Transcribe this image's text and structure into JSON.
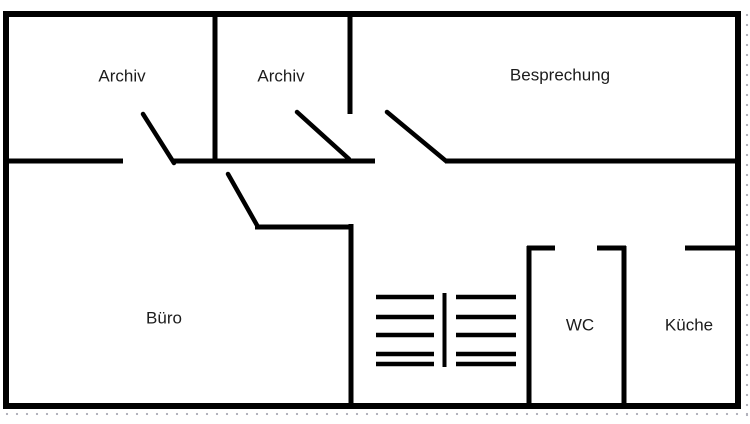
{
  "floorplan": {
    "rooms": [
      {
        "id": "archiv-1",
        "label": "Archiv"
      },
      {
        "id": "archiv-2",
        "label": "Archiv"
      },
      {
        "id": "besprechung",
        "label": "Besprechung"
      },
      {
        "id": "buero",
        "label": "Büro"
      },
      {
        "id": "wc",
        "label": "WC"
      },
      {
        "id": "kueche",
        "label": "Küche"
      }
    ]
  },
  "colors": {
    "wall": "#000000",
    "label_text": "#1c1c1c",
    "grid_dot": "#b2b2bc",
    "background": "#ffffff"
  }
}
